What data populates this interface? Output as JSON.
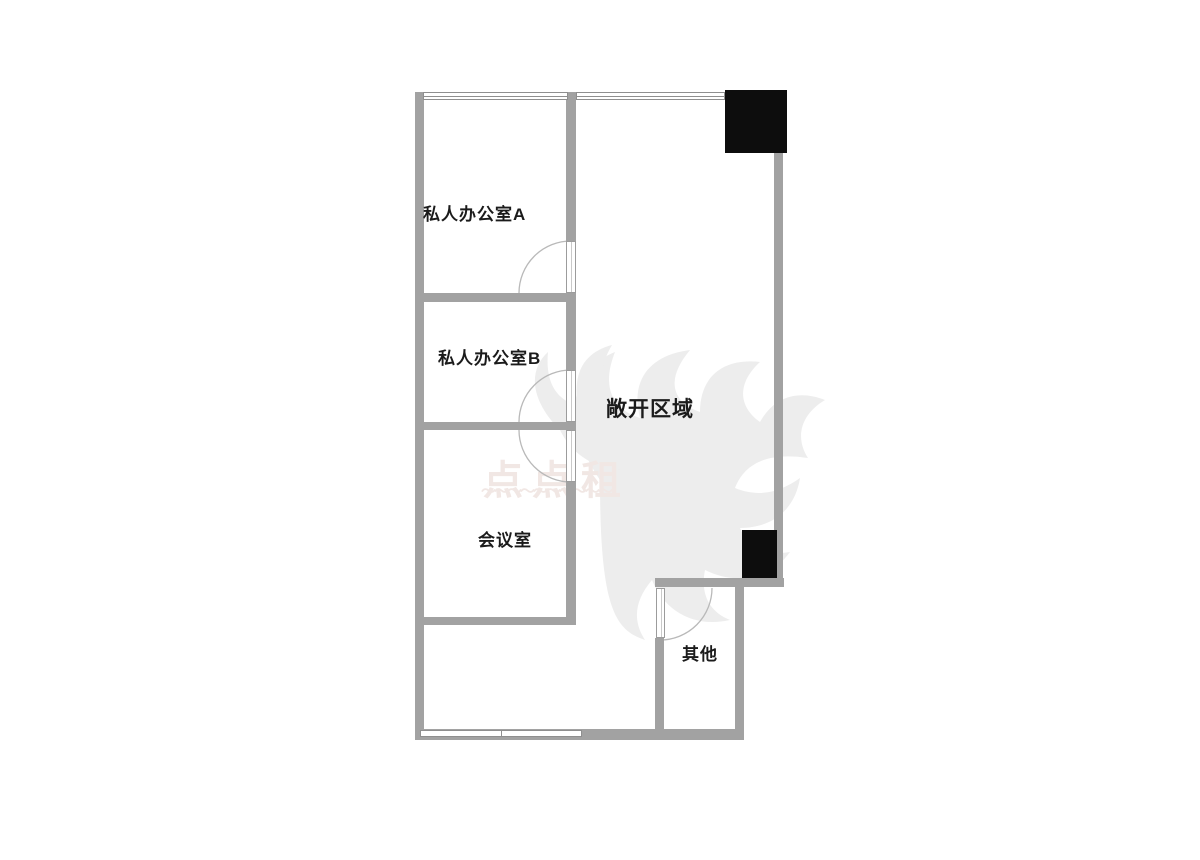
{
  "floorplan": {
    "title": "office floor plan",
    "rooms": [
      {
        "id": "private-office-a",
        "label": "私人办公室A"
      },
      {
        "id": "private-office-b",
        "label": "私人办公室B"
      },
      {
        "id": "open-area",
        "label": "敞开区域"
      },
      {
        "id": "meeting-room",
        "label": "会议室"
      },
      {
        "id": "other",
        "label": "其他"
      }
    ],
    "watermark": {
      "text": "点点租",
      "wave": "〜〜〜〜〜〜〜〜〜〜"
    },
    "colors": {
      "wall": "#a2a2a2",
      "wall_dark": "#8f8f8f",
      "column": "#0d0d0d",
      "door_arc": "#b9b9b9",
      "label": "#1b1b1b",
      "watermark_text": "#f1e7e4",
      "watermark_shape": "#ededed"
    }
  }
}
